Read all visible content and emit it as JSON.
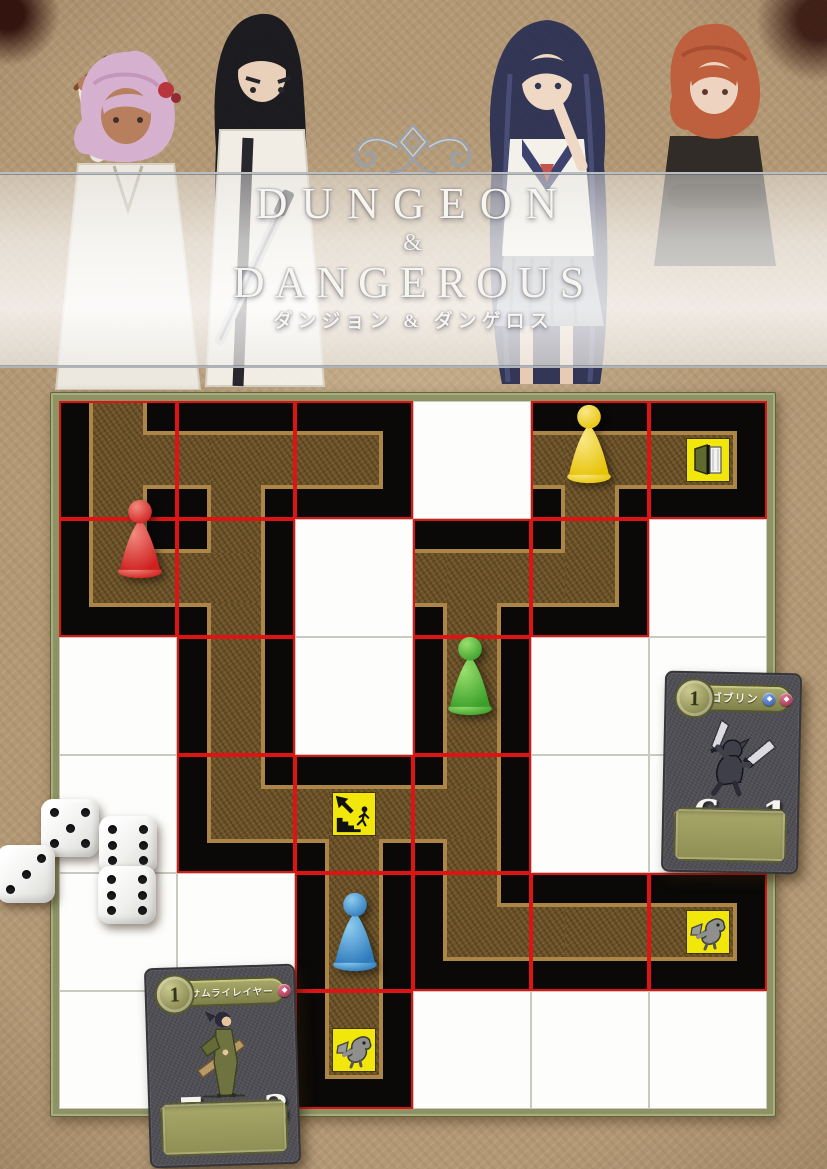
{
  "page": {
    "width": 827,
    "height": 1169,
    "background": "#b29875"
  },
  "title": {
    "line1": "DUNGEON",
    "ampersand": "&",
    "line2": "DANGEROUS",
    "subtitle": "ダンジョン & ダンゲロス",
    "text_color": "#f7f5f0"
  },
  "characters": [
    {
      "name": "pink-haired-writer"
    },
    {
      "name": "black-haired-swordsman"
    },
    {
      "name": "navy-haired-schoolgirl"
    },
    {
      "name": "red-haired-youth"
    }
  ],
  "board": {
    "frame": {
      "left": 50,
      "top": 392,
      "size": 724,
      "color": "#8d9365"
    },
    "grid": {
      "rows": 6,
      "cols": 6,
      "cell": 118,
      "red_line": "#de1414",
      "path_fill": "#6d5329",
      "path_rim": "#ac8647",
      "tile_yellow": "#f1e70b"
    },
    "cells": [
      [
        {
          "t": "d",
          "p": [
            "N",
            "E",
            "S"
          ]
        },
        {
          "t": "d",
          "p": [
            "W",
            "E",
            "S"
          ]
        },
        {
          "t": "d",
          "p": [
            "W"
          ]
        },
        {
          "t": "w"
        },
        {
          "t": "d",
          "p": [
            "W",
            "E",
            "S"
          ]
        },
        {
          "t": "d",
          "p": [
            "W"
          ],
          "icon": "door"
        }
      ],
      [
        {
          "t": "d",
          "p": [
            "N",
            "E"
          ]
        },
        {
          "t": "d",
          "p": [
            "N",
            "S",
            "W"
          ]
        },
        {
          "t": "w"
        },
        {
          "t": "d",
          "p": [
            "W",
            "E",
            "S"
          ]
        },
        {
          "t": "d",
          "p": [
            "W",
            "N"
          ]
        },
        {
          "t": "w"
        }
      ],
      [
        {
          "t": "w"
        },
        {
          "t": "d",
          "p": [
            "N",
            "S"
          ]
        },
        {
          "t": "w"
        },
        {
          "t": "d",
          "p": [
            "N",
            "S"
          ]
        },
        {
          "t": "w"
        },
        {
          "t": "w"
        }
      ],
      [
        {
          "t": "w"
        },
        {
          "t": "d",
          "p": [
            "N",
            "E"
          ]
        },
        {
          "t": "d",
          "p": [
            "W",
            "E",
            "S"
          ],
          "icon": "stairs"
        },
        {
          "t": "d",
          "p": [
            "N",
            "S",
            "W"
          ]
        },
        {
          "t": "w"
        },
        {
          "t": "w"
        }
      ],
      [
        {
          "t": "w"
        },
        {
          "t": "w"
        },
        {
          "t": "d",
          "p": [
            "N",
            "S"
          ]
        },
        {
          "t": "d",
          "p": [
            "N",
            "E"
          ]
        },
        {
          "t": "d",
          "p": [
            "W",
            "E"
          ]
        },
        {
          "t": "d",
          "p": [
            "W"
          ],
          "icon": "goblin"
        }
      ],
      [
        {
          "t": "w"
        },
        {
          "t": "w"
        },
        {
          "t": "d",
          "p": [
            "N"
          ],
          "icon": "goblin"
        },
        {
          "t": "w"
        },
        {
          "t": "w"
        },
        {
          "t": "w"
        }
      ]
    ],
    "icons": {
      "door": "open-door-icon",
      "stairs": "stairs-up-icon",
      "goblin": "goblin-monster-icon"
    }
  },
  "pawns": [
    {
      "color": "yellow",
      "hex": "#e7c40a",
      "hex_light": "#f9e886",
      "x": 589,
      "y": 482
    },
    {
      "color": "red",
      "hex": "#cf1f1f",
      "hex_light": "#f28a7e",
      "x": 140,
      "y": 577
    },
    {
      "color": "green",
      "hex": "#3ba02a",
      "hex_light": "#9ae06e",
      "x": 470,
      "y": 714
    },
    {
      "color": "blue",
      "hex": "#2d7abc",
      "hex_light": "#8ecdf0",
      "x": 355,
      "y": 970
    }
  ],
  "dice": [
    {
      "value": 5,
      "x": 70,
      "y": 828
    },
    {
      "value": 6,
      "x": 128,
      "y": 845
    },
    {
      "value": 3,
      "x": 26,
      "y": 874
    },
    {
      "value": 6,
      "x": 127,
      "y": 895
    }
  ],
  "cards": [
    {
      "id": "goblin",
      "level": "1",
      "name": "ゴブリン",
      "hp": "6",
      "atk": "1",
      "banner_icons": [
        "blue-die",
        "red-gem"
      ]
    },
    {
      "id": "samurai",
      "level": "1",
      "name": "サムライレイヤー",
      "hp": "7",
      "atk": "-3",
      "banner_icons": [
        "red-gem"
      ]
    }
  ]
}
